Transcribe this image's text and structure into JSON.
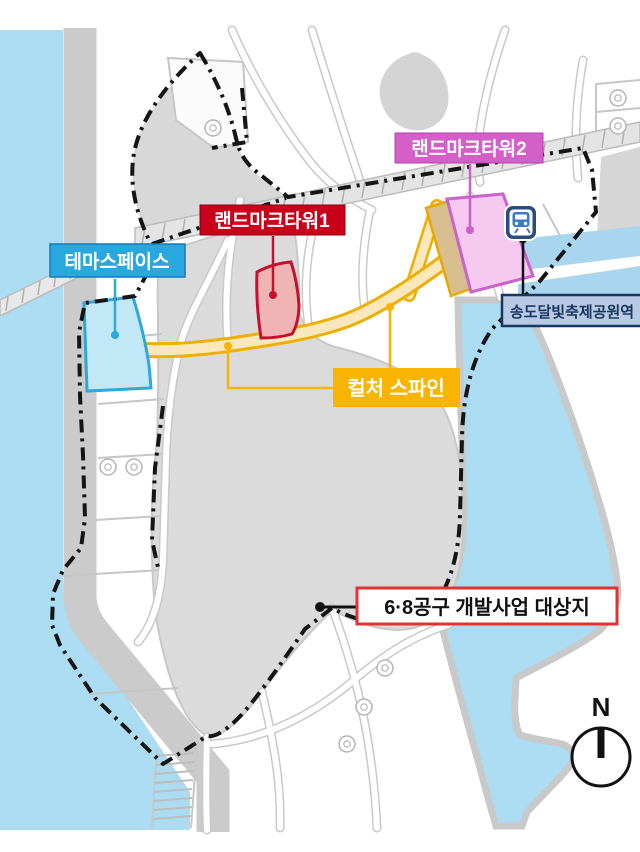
{
  "labels": {
    "landmark_tower_2": {
      "text": "랜드마크타워2",
      "bg": "#d45fc8"
    },
    "landmark_tower_1": {
      "text": "랜드마크타워1",
      "bg": "#c9001a"
    },
    "theme_space": {
      "text": "테마스페이스",
      "bg": "#29a8df"
    },
    "culture_spine": {
      "text": "컬처 스파인",
      "bg": "#f9b400"
    },
    "station": {
      "text": "송도달빛축제공원역",
      "bg": "#b7c9e4",
      "fg": "#17375e"
    },
    "project_site": {
      "text": "6·8공구 개발사업 대상지",
      "border": "#e23333"
    }
  },
  "compass": {
    "label": "N"
  },
  "icons": {
    "station_icon": "train-station-icon"
  },
  "colors": {
    "water": "#abdcf2",
    "shore_gray": "#cbcbcb",
    "district_gray": "#dbdbdb",
    "boundary": "#151515",
    "spine_fill": "#fae8bc",
    "spine_edge": "#efaf00",
    "theme_space_parcel": "#c2e8f8",
    "landmark1_parcel": "#f0b4b4",
    "landmark2_parcel": "#f6c9f0",
    "tan_parcel": "#d8be8e"
  }
}
